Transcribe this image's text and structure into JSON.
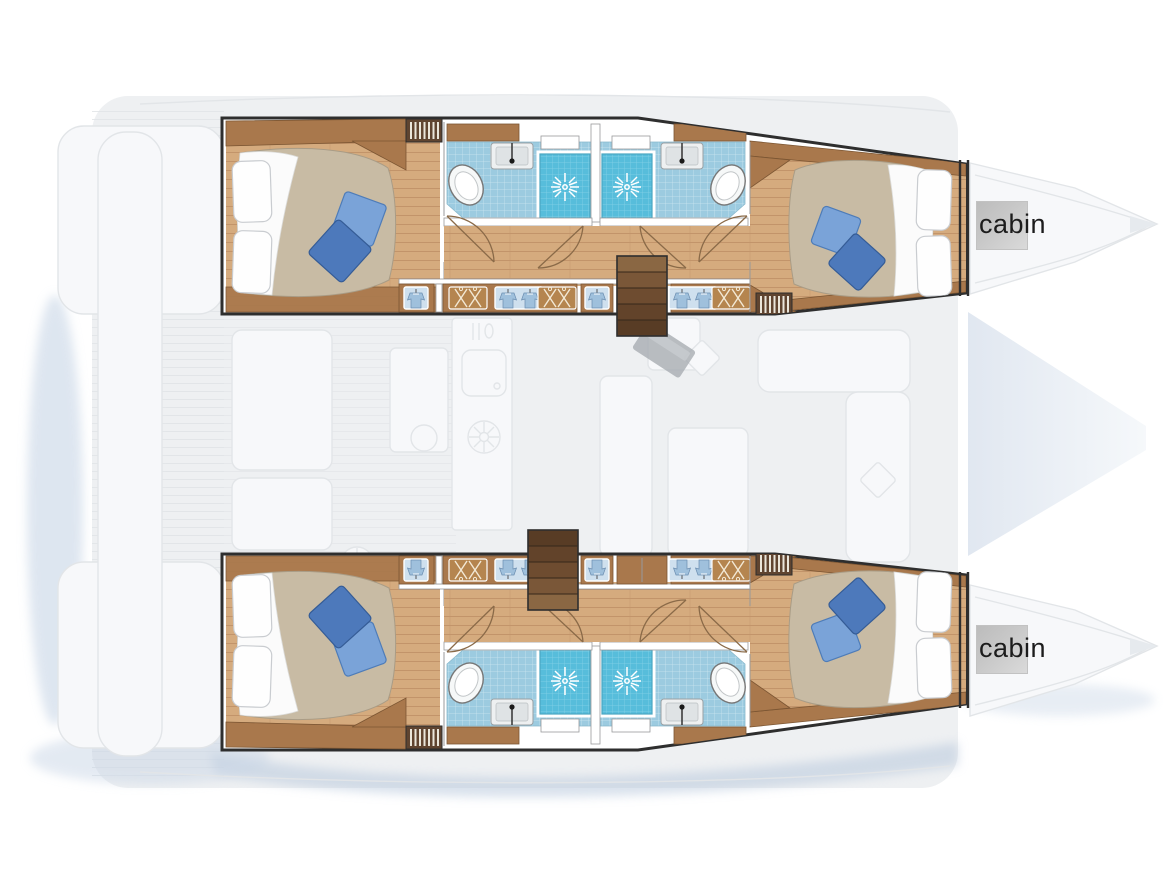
{
  "page": {
    "title": "Catamaran cabin layout floor plan",
    "canvas": {
      "width": 1173,
      "height": 879
    }
  },
  "labels": {
    "port_bow_cabin": "cabin",
    "starboard_bow_cabin": "cabin"
  },
  "plan": {
    "vessel_type": "catamaran",
    "hulls": [
      {
        "name": "port-hull",
        "rooms": [
          {
            "name": "aft-double-cabin",
            "features": [
              "double-bed",
              "white-pillows",
              "blue-throw-cushions",
              "air-vent-grille",
              "wardrobe"
            ]
          },
          {
            "name": "aft-bathroom",
            "features": [
              "toilet",
              "washbasin",
              "shower-cubicle",
              "blue-tiled-floor",
              "window"
            ]
          },
          {
            "name": "forward-bathroom",
            "features": [
              "toilet",
              "washbasin",
              "shower-cubicle",
              "blue-tiled-floor",
              "window"
            ]
          },
          {
            "name": "companionway-stairs",
            "features": [
              "steps-to-saloon"
            ]
          },
          {
            "name": "hanging-lockers",
            "features": [
              "hanger-lockers",
              "shirt-lockers"
            ]
          },
          {
            "name": "forward-double-cabin",
            "features": [
              "double-bed",
              "white-pillows",
              "blue-throw-cushions",
              "air-vent-grille"
            ]
          },
          {
            "name": "bow-cabin",
            "label": "cabin"
          }
        ]
      },
      {
        "name": "starboard-hull",
        "rooms": [
          {
            "name": "aft-double-cabin",
            "features": [
              "double-bed",
              "white-pillows",
              "blue-throw-cushions",
              "air-vent-grille",
              "wardrobe"
            ]
          },
          {
            "name": "aft-bathroom",
            "features": [
              "toilet",
              "washbasin",
              "shower-cubicle",
              "blue-tiled-floor",
              "window"
            ]
          },
          {
            "name": "forward-bathroom",
            "features": [
              "toilet",
              "washbasin",
              "shower-cubicle",
              "blue-tiled-floor",
              "window"
            ]
          },
          {
            "name": "companionway-stairs",
            "features": [
              "steps-to-saloon"
            ]
          },
          {
            "name": "hanging-lockers",
            "features": [
              "hanger-lockers",
              "shirt-lockers"
            ]
          },
          {
            "name": "forward-double-cabin",
            "features": [
              "double-bed",
              "white-pillows",
              "blue-throw-cushions",
              "air-vent-grille"
            ]
          },
          {
            "name": "bow-cabin",
            "label": "cabin"
          }
        ]
      }
    ],
    "ghosted_background": [
      "saloon",
      "galley-sink",
      "galley-counter",
      "fridge-hatch-circles",
      "dining-table",
      "l-shaped-sofa",
      "nav-panel",
      "cockpit-seats",
      "side-decks",
      "stern-platforms",
      "bow-foredecks"
    ]
  },
  "colors": {
    "background": "#ffffff",
    "ghost_fill": "#eef0f2",
    "ghost_line": "#e2e5e8",
    "ghost_white": "#f7f8fa",
    "shadow_blue": "#b9c9dd",
    "hull_outline": "#2e2e2e",
    "hull_wall": "#ffffff",
    "wall_line": "#98999b",
    "wood_floor": "#d5ab7e",
    "wood_floor_line": "#c2946a",
    "wood_cabinet": "#a9784c",
    "wood_cabinet_dark": "#7c5633",
    "wood_dark": "#5f4430",
    "tile_blue": "#9ccbe0",
    "tile_grid": "#cfe8f2",
    "shower_blue": "#57bddb",
    "shower_grid": "#8ad4e8",
    "fixture_white": "#f6f8f8",
    "fixture_line": "#777777",
    "sink_gray": "#dfe3e5",
    "duvet_beige": "#c8bba4",
    "sheet_white": "#fbfbfb",
    "cushion_blue_light": "#7aa3d8",
    "cushion_blue_dark": "#4d79bb",
    "hanger_panel": "#cfe0ee",
    "shirt_blue": "#9fc0dc",
    "door_arc": "#8a6a48",
    "label_square": "#c8c8c8",
    "label_text": "#1c1c1c"
  }
}
